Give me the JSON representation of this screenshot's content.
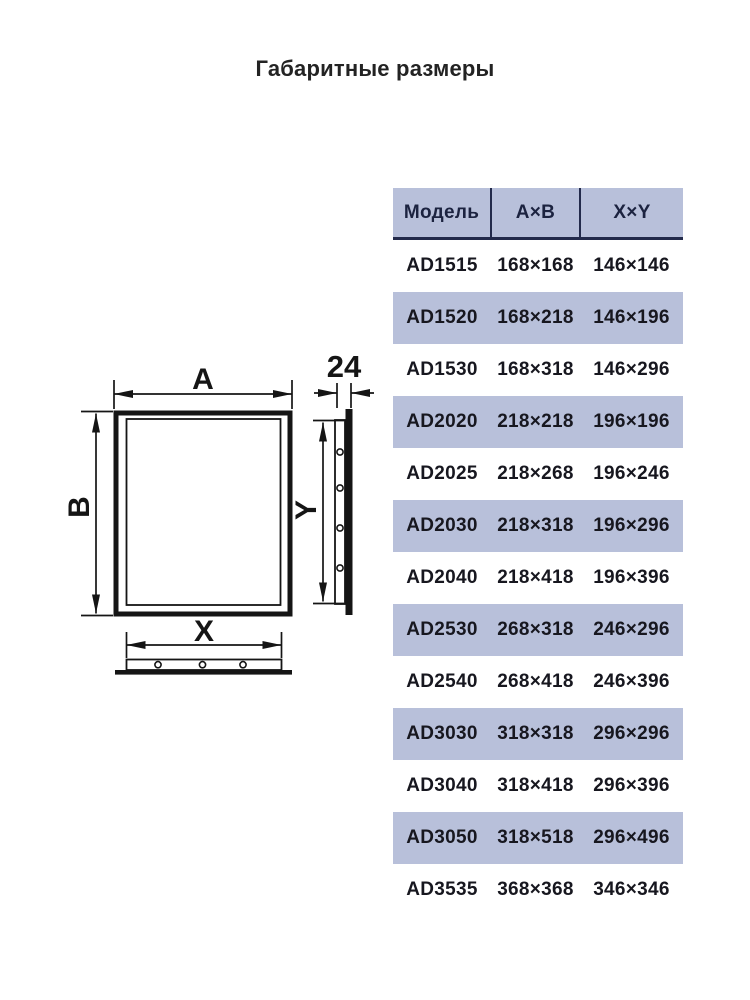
{
  "title": "Габаритные размеры",
  "drawing": {
    "labels": {
      "a": "A",
      "b": "B",
      "x": "X",
      "y": "Y",
      "depth": "24"
    }
  },
  "table": {
    "headers": {
      "model": "Модель",
      "ab": "A×B",
      "xy": "X×Y"
    },
    "rows": [
      {
        "model": "AD1515",
        "ab": "168×168",
        "xy": "146×146"
      },
      {
        "model": "AD1520",
        "ab": "168×218",
        "xy": "146×196"
      },
      {
        "model": "AD1530",
        "ab": "168×318",
        "xy": "146×296"
      },
      {
        "model": "AD2020",
        "ab": "218×218",
        "xy": "196×196"
      },
      {
        "model": "AD2025",
        "ab": "218×268",
        "xy": "196×246"
      },
      {
        "model": "AD2030",
        "ab": "218×318",
        "xy": "196×296"
      },
      {
        "model": "AD2040",
        "ab": "218×418",
        "xy": "196×396"
      },
      {
        "model": "AD2530",
        "ab": "268×318",
        "xy": "246×296"
      },
      {
        "model": "AD2540",
        "ab": "268×418",
        "xy": "246×396"
      },
      {
        "model": "AD3030",
        "ab": "318×318",
        "xy": "296×296"
      },
      {
        "model": "AD3040",
        "ab": "318×418",
        "xy": "296×396"
      },
      {
        "model": "AD3050",
        "ab": "318×518",
        "xy": "296×496"
      },
      {
        "model": "AD3535",
        "ab": "368×368",
        "xy": "346×346"
      }
    ]
  },
  "colors": {
    "stripe": "#b8c0da",
    "header_bg": "#b8c0da",
    "divider": "#232a4b",
    "header_text": "#1c2340",
    "body_text": "#17171f",
    "line": "#151515",
    "title_text": "#232323",
    "background": "#ffffff"
  }
}
